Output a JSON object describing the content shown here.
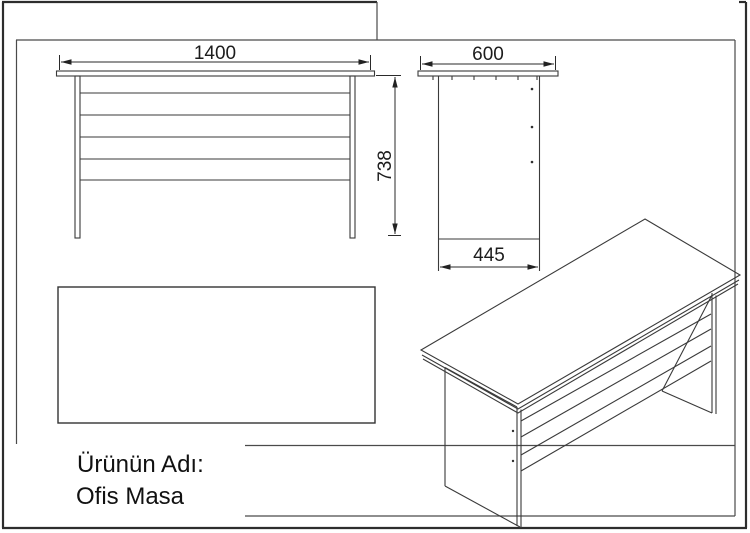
{
  "sheet": {
    "background": "#ffffff",
    "line_color": "#3a3a3a",
    "frame_color": "#2d2d2d",
    "text_color": "#111111"
  },
  "views": {
    "front": {
      "width_label": "1400",
      "height_label": "738"
    },
    "side": {
      "width_label": "600",
      "depth_label": "445"
    }
  },
  "title_block": {
    "label": "Ürünün Adı:",
    "product_name": "Ofis Masa"
  }
}
